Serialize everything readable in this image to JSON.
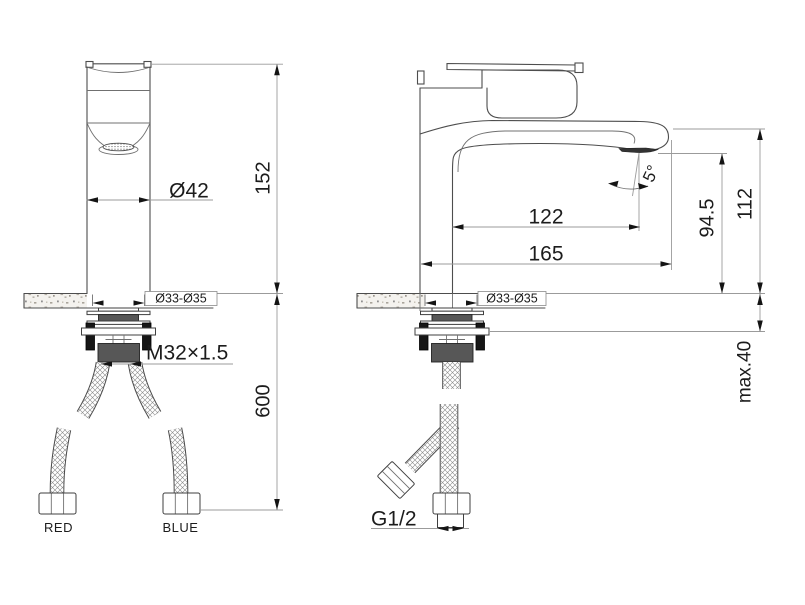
{
  "front_view": {
    "spout_diameter": "Ø42",
    "height_to_deck": "152",
    "deck_hole_diameter": "Ø33-Ø35",
    "body_thread": "M32×1.5",
    "hose_length": "600",
    "hot_hose_label": "RED",
    "cold_hose_label": "BLUE"
  },
  "side_view": {
    "spout_reach": "122",
    "overall_reach": "165",
    "spray_angle": "5°",
    "spout_height": "94.5",
    "overall_height": "112",
    "deck_hole_diameter": "Ø33-Ø35",
    "max_deck_thickness": "max.40",
    "supply_thread": "G1/2"
  },
  "colors": {
    "outline": "#4d4d4d",
    "dimension_line": "#9b9b9b",
    "text": "#1c1c1c",
    "hardware_gray": "#575757",
    "hardware_black": "#161616"
  }
}
